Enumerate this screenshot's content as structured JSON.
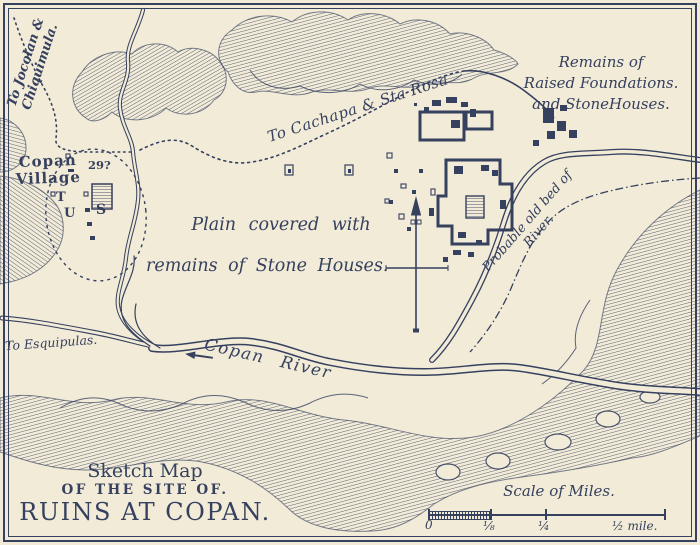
{
  "colors": {
    "paper": "#f1ebd7",
    "ink": "#36405f"
  },
  "title": {
    "line1": "Sketch Map",
    "line2": "OF THE SITE OF.",
    "line3": "RUINS AT COPAN."
  },
  "labels": {
    "jocolan_line1": "To Jocolan &",
    "jocolan_line2": "Chiquimula.",
    "village_line1": "Copan",
    "village_line2": "Village",
    "cachapa": "To Cachapa & Sta Rosa",
    "remains_line1": "Remains of",
    "remains_line2": "Raised Foundations.",
    "remains_line3": "and StoneHouses.",
    "plain_line1": "Plain covered with",
    "plain_line2": "remains of Stone Houses.",
    "old_bed_line1": "Probable old bed of",
    "old_bed_line2": "River.",
    "esquipulas": "To Esquipulas.",
    "river": "Copan River",
    "ruin_number": "29?",
    "ruin_t": "T",
    "ruin_u": "U",
    "ruin_s": "S"
  },
  "scale": {
    "title": "Scale of Miles.",
    "tick0": "0",
    "tick1": "⅛",
    "tick2": "¼",
    "tick3": "½ mile."
  }
}
